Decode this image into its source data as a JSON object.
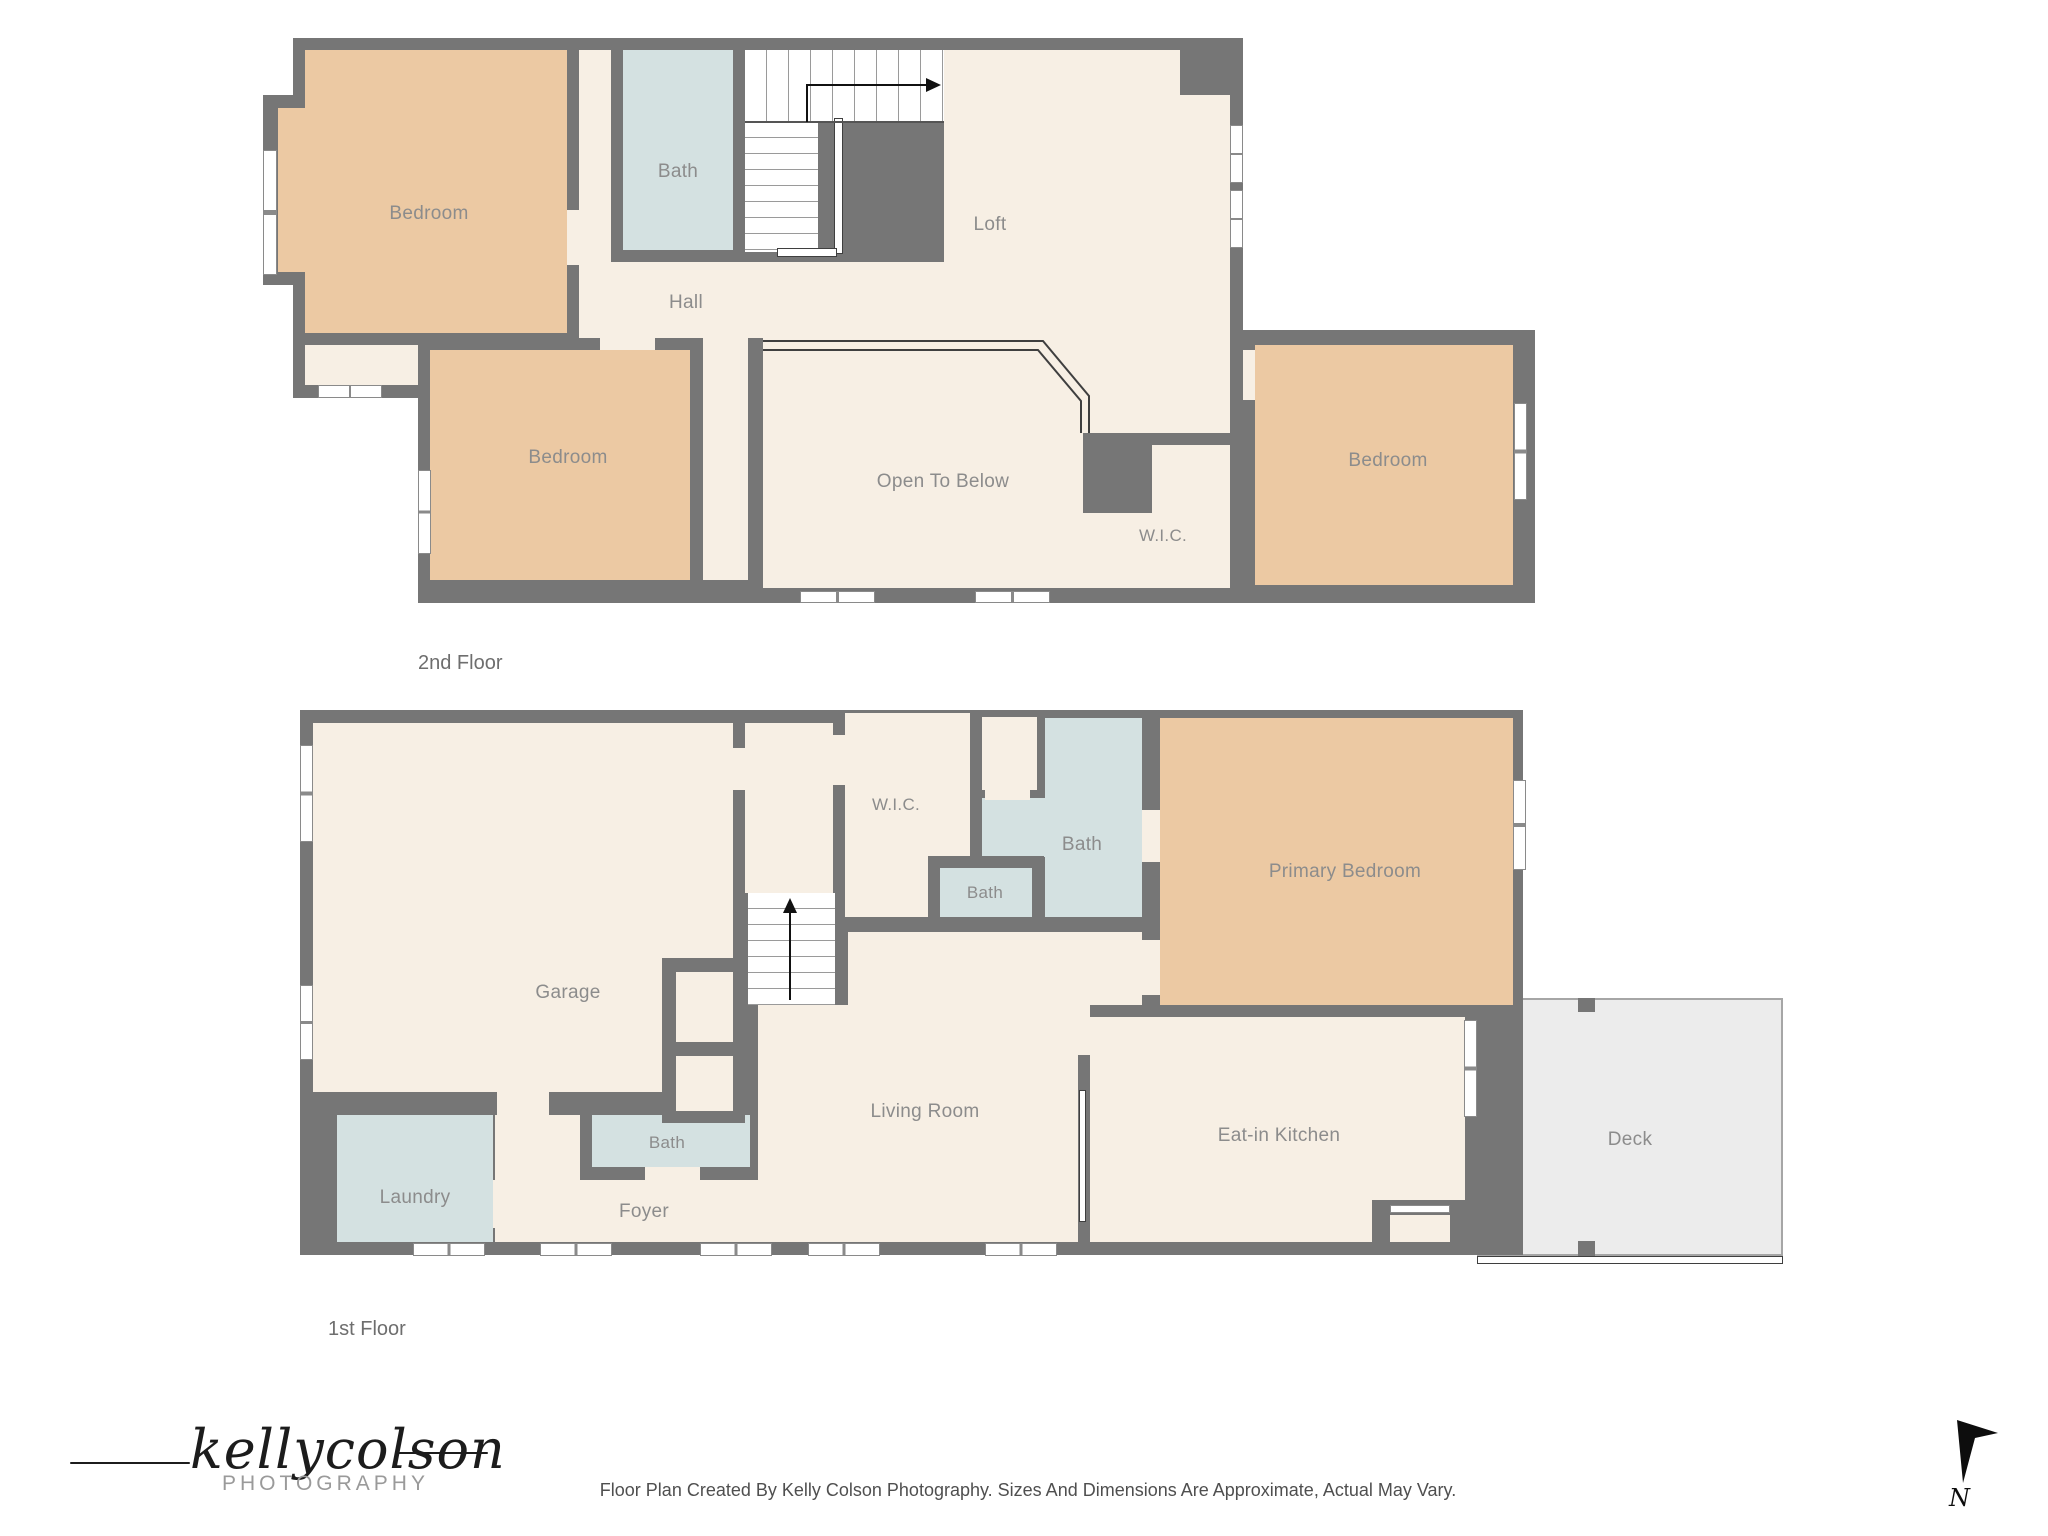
{
  "document": {
    "type": "floor-plan",
    "disclaimer": "Floor Plan Created By Kelly Colson Photography. Sizes And Dimensions Are Approximate, Actual May Vary."
  },
  "branding": {
    "logo_script": "kellycolson",
    "logo_sub": "PHOTOGRAPHY"
  },
  "compass": {
    "north_label": "N"
  },
  "colors": {
    "wall": "#767676",
    "floor_cream": "#f7efe4",
    "bedroom_tan": "#ecc9a3",
    "bath_blue": "#d4e1e1",
    "deck_gray": "#ececec",
    "label_gray": "#8c8c8c"
  },
  "floors": {
    "second": {
      "name_label": "2nd Floor",
      "rooms": {
        "bedroom_left": "Bedroom",
        "bath": "Bath",
        "loft": "Loft",
        "hall": "Hall",
        "bedroom_mid": "Bedroom",
        "open_to_below": "Open To Below",
        "wic": "W.I.C.",
        "bedroom_right": "Bedroom"
      }
    },
    "first": {
      "name_label": "1st Floor",
      "rooms": {
        "garage": "Garage",
        "wic": "W.I.C.",
        "bath_main": "Bath",
        "bath_small": "Bath",
        "primary_bedroom": "Primary Bedroom",
        "living_room": "Living Room",
        "eat_in_kitchen": "Eat-in Kitchen",
        "deck": "Deck",
        "laundry": "Laundry",
        "bath_foyer": "Bath",
        "foyer": "Foyer"
      }
    }
  }
}
